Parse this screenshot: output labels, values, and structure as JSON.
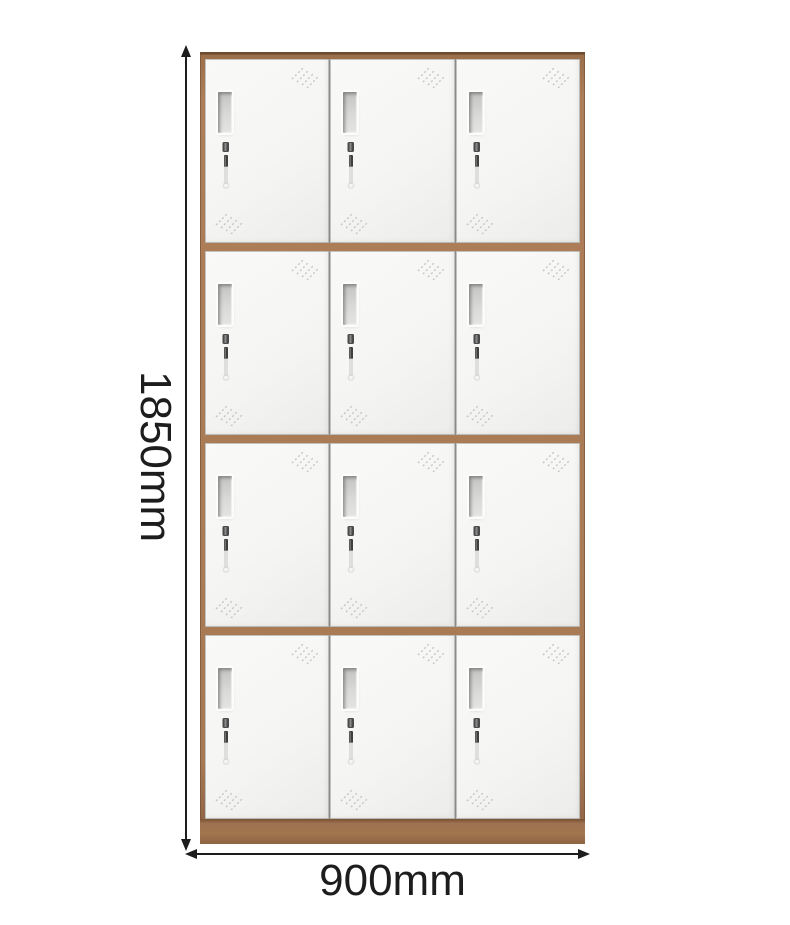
{
  "product": {
    "name": "12-door locker cabinet",
    "grid": {
      "rows": 4,
      "columns": 3,
      "door_count": 12
    }
  },
  "annotations": {
    "height_label": "1850mm",
    "width_label": "900mm"
  },
  "icons": {
    "vent_slits": "diagonal-dashed-vent-slits-icon",
    "vent_window": "recessed-louver-slot",
    "lock_and_key": "cam-lock-with-hanging-key-icon",
    "dimension_arrows": "double-headed-dimension-arrows"
  },
  "colors": {
    "frame_brown": "#a87a54",
    "frame_edge": "#6f4c2f",
    "plinth_brown": "#9d7150",
    "door_white": "#f6f6f5",
    "door_edge": "#9b9b99",
    "vent_gray": "#c6c6c5",
    "dimension_ink": "#1d1d1d",
    "background": "#ffffff"
  }
}
